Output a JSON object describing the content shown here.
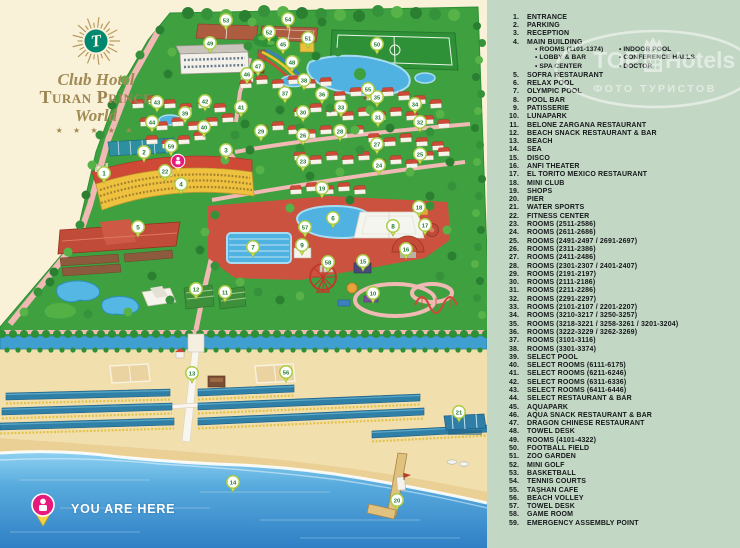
{
  "logo": {
    "brand_top": "Club Hotel",
    "brand_main": "Turan Prince",
    "brand_sub": "World",
    "stars": "★ ★ ★ ★ ★"
  },
  "you_are_here": {
    "label": "YOU ARE HERE"
  },
  "watermark": {
    "top": "TOP",
    "hotels": "Hotels",
    "sub": "ФОТО ТУРИСТОВ"
  },
  "colors": {
    "cream_bg": "#FAF2D8",
    "legend_bg": "#C3D7C5",
    "land_green": "#3FA040",
    "roof_red": "#CE4A36",
    "hotel_yellow": "#EEC13F",
    "pool_blue": "#4FB2E0",
    "sea_deep": "#2F7FC5",
    "sand": "#F2DFAE",
    "path_pink": "#F0B9B4",
    "marker_number_green": "#217A2F",
    "pin_pink": "#E8197D"
  },
  "legend": {
    "items": [
      {
        "n": "1",
        "label": "ENTRANCE"
      },
      {
        "n": "2",
        "label": "PARKING"
      },
      {
        "n": "3",
        "label": "RECEPTION"
      },
      {
        "n": "4",
        "label": "MAIN BUILDING",
        "sub": {
          "left": [
            "ROOMS (1101-1374)",
            "LOBBY & BAR",
            "SPA CENTER"
          ],
          "right": [
            "INDOOR POOL",
            "CONFERENCE HALLS",
            "DOCTOR"
          ]
        }
      },
      {
        "n": "5",
        "label": "SOFRA RESTAURANT"
      },
      {
        "n": "6",
        "label": "RELAX POOL"
      },
      {
        "n": "7",
        "label": "OLYMPIC POOL"
      },
      {
        "n": "8",
        "label": "POOL BAR"
      },
      {
        "n": "9",
        "label": "PATISSERIE"
      },
      {
        "n": "10",
        "label": "LUNAPARK"
      },
      {
        "n": "11",
        "label": "BELONE ZARGANA RESTAURANT"
      },
      {
        "n": "12",
        "label": "BEACH SNACK RESTAURANT & BAR"
      },
      {
        "n": "13",
        "label": "BEACH"
      },
      {
        "n": "14",
        "label": "SEA"
      },
      {
        "n": "15",
        "label": "DISCO"
      },
      {
        "n": "16",
        "label": "ANFI THEATER"
      },
      {
        "n": "17",
        "label": "EL TORITO MEXICO RESTAURANT"
      },
      {
        "n": "18",
        "label": "MINI CLUB"
      },
      {
        "n": "19",
        "label": "SHOPS"
      },
      {
        "n": "20",
        "label": "PIER"
      },
      {
        "n": "21",
        "label": "WATER SPORTS"
      },
      {
        "n": "22",
        "label": "FITNESS CENTER"
      },
      {
        "n": "23",
        "label": "ROOMS (2511-2586)"
      },
      {
        "n": "24",
        "label": "ROOMS (2611-2686)"
      },
      {
        "n": "25",
        "label": "ROOMS (2491-2497 / 2691-2697)"
      },
      {
        "n": "26",
        "label": "ROOMS (2311-2386)"
      },
      {
        "n": "27",
        "label": "ROOMS (2411-2486)"
      },
      {
        "n": "28",
        "label": "ROOMS (2301-2307 / 2401-2407)"
      },
      {
        "n": "29",
        "label": "ROOMS (2191-2197)"
      },
      {
        "n": "30",
        "label": "ROOMS (2111-2186)"
      },
      {
        "n": "31",
        "label": "ROOMS (2211-2286)"
      },
      {
        "n": "32",
        "label": "ROOMS (2291-2297)"
      },
      {
        "n": "33",
        "label": "ROOMS (2101-2107 / 2201-2207)"
      },
      {
        "n": "34",
        "label": "ROOMS (3210-3217 / 3250-3257)"
      },
      {
        "n": "35",
        "label": "ROOMS (3218-3221 / 3258-3261 / 3201-3204)"
      },
      {
        "n": "36",
        "label": "ROOMS (3222-3229 / 3262-3269)"
      },
      {
        "n": "37",
        "label": "ROOMS (3101-3116)"
      },
      {
        "n": "38",
        "label": "ROOMS (3301-3374)"
      },
      {
        "n": "39",
        "label": "SELECT POOL"
      },
      {
        "n": "40",
        "label": "SELECT ROOMS (6111-6175)"
      },
      {
        "n": "41",
        "label": "SELECT ROOMS (6211-6246)"
      },
      {
        "n": "42",
        "label": "SELECT ROOMS (6311-6336)"
      },
      {
        "n": "43",
        "label": "SELECT ROOMS (6411-6446)"
      },
      {
        "n": "44",
        "label": "SELECT RESTAURANT & BAR"
      },
      {
        "n": "45",
        "label": "AQUAPARK"
      },
      {
        "n": "46",
        "label": "AQUA SNACK RESTAURANT & BAR"
      },
      {
        "n": "47",
        "label": "DRAGON CHINESE RESTAURANT"
      },
      {
        "n": "48",
        "label": "TOWEL DESK"
      },
      {
        "n": "49",
        "label": "ROOMS (4101-4322)"
      },
      {
        "n": "50",
        "label": "FOOTBALL FIELD"
      },
      {
        "n": "51",
        "label": "ZOO GARDEN"
      },
      {
        "n": "52",
        "label": "MINI GOLF"
      },
      {
        "n": "53",
        "label": "BASKETBALL"
      },
      {
        "n": "54",
        "label": "TENNIS COURTS"
      },
      {
        "n": "55",
        "label": "TAŞHAN CAFE"
      },
      {
        "n": "56",
        "label": "BEACH VOLLEY"
      },
      {
        "n": "57",
        "label": "TOWEL DESK"
      },
      {
        "n": "58",
        "label": "GAME ROOM"
      },
      {
        "n": "59",
        "label": "EMERGENCY ASSEMBLY POINT"
      }
    ]
  },
  "map": {
    "markers": [
      {
        "n": 1,
        "x": 104,
        "y": 173
      },
      {
        "n": 2,
        "x": 144,
        "y": 152
      },
      {
        "n": 3,
        "x": 226,
        "y": 150
      },
      {
        "n": 4,
        "x": 181,
        "y": 184
      },
      {
        "n": 5,
        "x": 138,
        "y": 227
      },
      {
        "n": 6,
        "x": 333,
        "y": 218
      },
      {
        "n": 7,
        "x": 253,
        "y": 247
      },
      {
        "n": 8,
        "x": 393,
        "y": 226
      },
      {
        "n": 9,
        "x": 302,
        "y": 245
      },
      {
        "n": 10,
        "x": 373,
        "y": 293
      },
      {
        "n": 11,
        "x": 225,
        "y": 292
      },
      {
        "n": 12,
        "x": 196,
        "y": 289
      },
      {
        "n": 13,
        "x": 192,
        "y": 373
      },
      {
        "n": 14,
        "x": 233,
        "y": 482
      },
      {
        "n": 15,
        "x": 363,
        "y": 261
      },
      {
        "n": 16,
        "x": 406,
        "y": 249
      },
      {
        "n": 17,
        "x": 425,
        "y": 225
      },
      {
        "n": 18,
        "x": 419,
        "y": 207
      },
      {
        "n": 19,
        "x": 322,
        "y": 188
      },
      {
        "n": 20,
        "x": 397,
        "y": 500
      },
      {
        "n": 21,
        "x": 459,
        "y": 412
      },
      {
        "n": 22,
        "x": 165,
        "y": 171
      },
      {
        "n": 23,
        "x": 303,
        "y": 161
      },
      {
        "n": 24,
        "x": 379,
        "y": 165
      },
      {
        "n": 25,
        "x": 420,
        "y": 154
      },
      {
        "n": 26,
        "x": 303,
        "y": 135
      },
      {
        "n": 27,
        "x": 377,
        "y": 144
      },
      {
        "n": 28,
        "x": 340,
        "y": 131
      },
      {
        "n": 29,
        "x": 261,
        "y": 131
      },
      {
        "n": 30,
        "x": 303,
        "y": 112
      },
      {
        "n": 31,
        "x": 378,
        "y": 117
      },
      {
        "n": 32,
        "x": 420,
        "y": 122
      },
      {
        "n": 33,
        "x": 341,
        "y": 107
      },
      {
        "n": 34,
        "x": 415,
        "y": 104
      },
      {
        "n": 35,
        "x": 377,
        "y": 97
      },
      {
        "n": 36,
        "x": 322,
        "y": 94
      },
      {
        "n": 37,
        "x": 285,
        "y": 93
      },
      {
        "n": 38,
        "x": 304,
        "y": 80
      },
      {
        "n": 39,
        "x": 185,
        "y": 113
      },
      {
        "n": 40,
        "x": 204,
        "y": 127
      },
      {
        "n": 41,
        "x": 241,
        "y": 107
      },
      {
        "n": 42,
        "x": 205,
        "y": 101
      },
      {
        "n": 43,
        "x": 157,
        "y": 102
      },
      {
        "n": 44,
        "x": 152,
        "y": 122
      },
      {
        "n": 45,
        "x": 283,
        "y": 44
      },
      {
        "n": 46,
        "x": 247,
        "y": 74
      },
      {
        "n": 47,
        "x": 258,
        "y": 66
      },
      {
        "n": 48,
        "x": 292,
        "y": 62
      },
      {
        "n": 49,
        "x": 210,
        "y": 43
      },
      {
        "n": 50,
        "x": 377,
        "y": 44
      },
      {
        "n": 51,
        "x": 308,
        "y": 38
      },
      {
        "n": 52,
        "x": 269,
        "y": 32
      },
      {
        "n": 53,
        "x": 226,
        "y": 20
      },
      {
        "n": 54,
        "x": 288,
        "y": 19
      },
      {
        "n": 55,
        "x": 368,
        "y": 89
      },
      {
        "n": 56,
        "x": 286,
        "y": 372
      },
      {
        "n": 57,
        "x": 305,
        "y": 227
      },
      {
        "n": 58,
        "x": 328,
        "y": 262
      },
      {
        "n": 59,
        "x": 171,
        "y": 146
      }
    ]
  }
}
